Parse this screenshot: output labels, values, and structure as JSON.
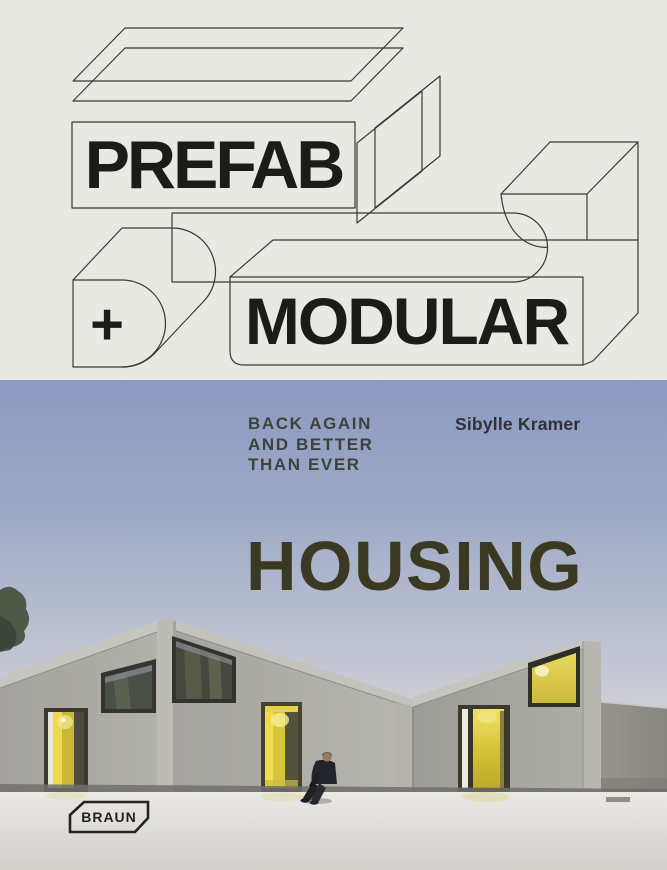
{
  "cover": {
    "prefab": "PREFAB",
    "plus": "+",
    "modular": "MODULAR",
    "tagline": {
      "line1": "BACK AGAIN",
      "line2": "AND BETTER",
      "line3": "THAN EVER"
    },
    "author": "Sibylle Kramer",
    "title": "HOUSING",
    "publisher": "BRAUN",
    "colors": {
      "cream_background": "#e9e9e3",
      "line_art": "#3a3a35",
      "title_olive": "#3a3922",
      "tagline_gray": "#3f4239",
      "sky_top": "#8c9ac1",
      "sky_horizon": "#e4dedb",
      "concrete": "#a8a7a1",
      "accent_yellow": "#e0cd3f",
      "pavement": "#dcdad5"
    }
  }
}
